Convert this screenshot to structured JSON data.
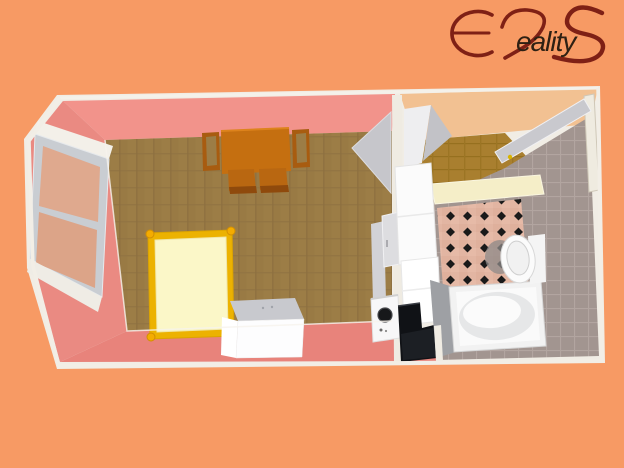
{
  "logo": {
    "text": "ERS Reality",
    "suffix": "eality",
    "color_primary": "#7E2015",
    "color_suffix": "#2E2013"
  },
  "colors": {
    "background": "#F79A64",
    "trim": "#F1EDE5",
    "wall_pink_light": "#F2938B",
    "wall_pink": "#EA8A82",
    "wall_pink_dark": "#E8837B",
    "floor_brown": "#9C7D46",
    "floor_brown_line": "#8D7040",
    "hall_floor": "#A97F2F",
    "hall_wall_tan": "#F2C192",
    "door_gray": "#C9C9CE",
    "window_glass": "#DFA98E",
    "window_frame": "#C9CDD2",
    "bath_tile": "#E2B5A2",
    "bath_tile_diamond": "#1A1A1A",
    "gray_wall": "#A29590",
    "gray_wall_line": "#B2A5A0",
    "wood_table": "#C56F10",
    "wood_chair": "#A85C10",
    "bed_frame": "#ECB201",
    "bed_mattress": "#FBF7C8",
    "bed_knob": "#F4AC00",
    "appliance_white": "#FBFBFB",
    "appliance_black": "#101216"
  },
  "scene": {
    "description": "3D overhead rendering of a studio apartment floor plan",
    "rooms": [
      {
        "name": "main room",
        "contents": [
          "window",
          "dining table with four chairs",
          "double bed",
          "white cabinet"
        ]
      },
      {
        "name": "kitchen corner",
        "contents": [
          "tall cabinet",
          "base cabinet",
          "washing machine",
          "black stove"
        ]
      },
      {
        "name": "entry hall",
        "contents": [
          "open entrance door",
          "corner wardrobe"
        ]
      },
      {
        "name": "bathroom",
        "contents": [
          "checkered tile floor",
          "toilet",
          "bathtub",
          "gray tiled wall"
        ]
      }
    ]
  }
}
